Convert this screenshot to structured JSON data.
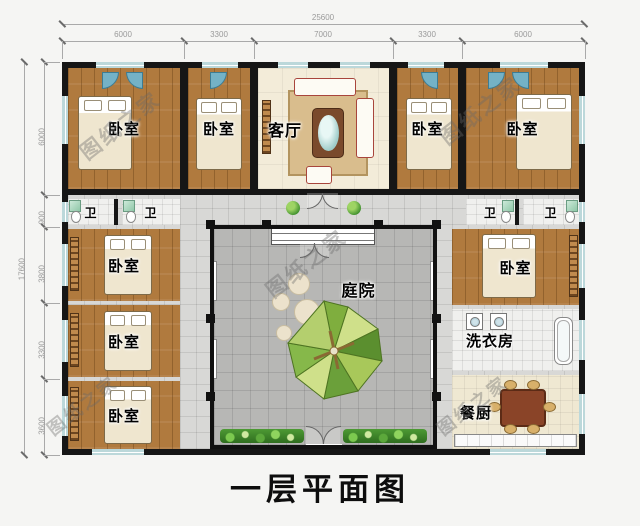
{
  "meta": {
    "title": "一层平面图",
    "watermark": "图纸之家"
  },
  "dimensions": {
    "top": {
      "total": "25600",
      "segments": [
        "6000",
        "3300",
        "7000",
        "3300",
        "6000"
      ]
    },
    "left": {
      "total": "17600",
      "segments": [
        "6000",
        "900",
        "3800",
        "3300",
        "3600"
      ]
    }
  },
  "rooms": {
    "top": [
      {
        "label": "卧室"
      },
      {
        "label": "卧室"
      },
      {
        "label": "客厅"
      },
      {
        "label": "卧室"
      },
      {
        "label": "卧室"
      }
    ],
    "baths": [
      {
        "label": "卫"
      },
      {
        "label": "卫"
      },
      {
        "label": "卫"
      },
      {
        "label": "卫"
      }
    ],
    "left": [
      {
        "label": "卧室"
      },
      {
        "label": "卧室"
      },
      {
        "label": "卧室"
      }
    ],
    "right": [
      {
        "label": "卧室"
      },
      {
        "label": "洗衣房"
      },
      {
        "label": "餐厨"
      }
    ],
    "courtyard": {
      "label": "庭院"
    }
  },
  "colors": {
    "wall": "#161616",
    "wood_floor": "#b07a3e",
    "courtyard_paving": "#b7b7b5",
    "window": "#bcd8da",
    "plants": "#4d9a34"
  }
}
